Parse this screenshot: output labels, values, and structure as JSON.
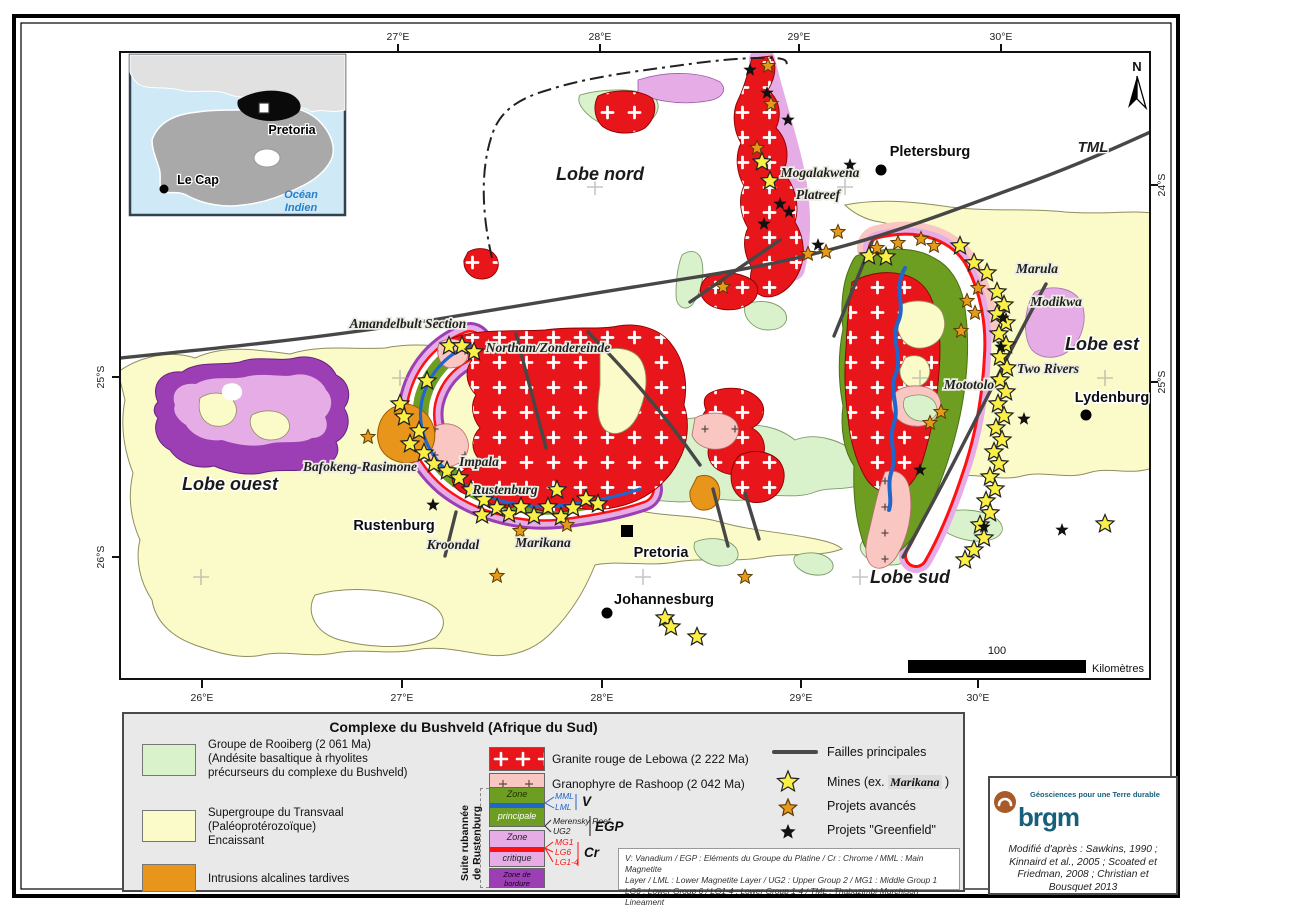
{
  "inset": {
    "pretoria": "Pretoria",
    "le_cap": "Le Cap",
    "ocean_line1": "Océan",
    "ocean_line2": "Indien"
  },
  "axes": {
    "top": [
      {
        "x": 398,
        "t": "27°E"
      },
      {
        "x": 600,
        "t": "28°E"
      },
      {
        "x": 799,
        "t": "29°E"
      },
      {
        "x": 1001,
        "t": "30°E"
      }
    ],
    "bottom": [
      {
        "x": 202,
        "t": "26°E"
      },
      {
        "x": 402,
        "t": "27°E"
      },
      {
        "x": 602,
        "t": "28°E"
      },
      {
        "x": 801,
        "t": "29°E"
      },
      {
        "x": 978,
        "t": "30°E"
      }
    ],
    "left": [
      {
        "y": 377,
        "t": "25°S"
      },
      {
        "y": 557,
        "t": "26°S"
      }
    ],
    "right": [
      {
        "y": 185,
        "t": "24°S"
      },
      {
        "y": 382,
        "t": "25°S"
      }
    ]
  },
  "map": {
    "north_label": "N",
    "fault_label": {
      "text": "TML",
      "x": 1093,
      "y": 152
    },
    "region_labels": [
      {
        "text": "Lobe nord",
        "x": 600,
        "y": 180
      },
      {
        "text": "Lobe ouest",
        "x": 230,
        "y": 490
      },
      {
        "text": "Lobe est",
        "x": 1102,
        "y": 350
      },
      {
        "text": "Lobe sud",
        "x": 910,
        "y": 583
      }
    ],
    "mine_labels": [
      {
        "text": "Amandelbult Section",
        "x": 408,
        "y": 328
      },
      {
        "text": "Northam/Zondereinde",
        "x": 548,
        "y": 352
      },
      {
        "text": "Bafokeng-Rasimone",
        "x": 360,
        "y": 471
      },
      {
        "text": "Impala",
        "x": 479,
        "y": 466
      },
      {
        "text": "Rustenburg",
        "x": 505,
        "y": 494
      },
      {
        "text": "Kroondal",
        "x": 453,
        "y": 549
      },
      {
        "text": "Marikana",
        "x": 543,
        "y": 547
      },
      {
        "text": "Mogalakwena",
        "x": 820,
        "y": 177
      },
      {
        "text": "Platreef",
        "x": 818,
        "y": 199
      },
      {
        "text": "Marula",
        "x": 1037,
        "y": 273
      },
      {
        "text": "Modikwa",
        "x": 1056,
        "y": 306
      },
      {
        "text": "Two Rivers",
        "x": 1048,
        "y": 373
      },
      {
        "text": "Mototolo",
        "x": 969,
        "y": 389
      }
    ],
    "cities": [
      {
        "name": "Pletersburg",
        "lx": 930,
        "ly": 156,
        "marker": "dot",
        "mx": 881,
        "my": 170
      },
      {
        "name": "Lydenburg",
        "lx": 1112,
        "ly": 402,
        "marker": "dot",
        "mx": 1086,
        "my": 415
      },
      {
        "name": "Pretoria",
        "lx": 661,
        "ly": 557,
        "marker": "square",
        "mx": 627,
        "my": 531
      },
      {
        "name": "Johannesburg",
        "lx": 664,
        "ly": 604,
        "marker": "dot",
        "mx": 607,
        "my": 613
      },
      {
        "name": "Rustenburg",
        "lx": 394,
        "ly": 530,
        "marker": "none",
        "mx": 0,
        "my": 0
      }
    ],
    "graticule": [
      [
        595,
        187
      ],
      [
        845,
        187
      ],
      [
        400,
        378
      ],
      [
        920,
        378
      ],
      [
        1105,
        378
      ],
      [
        201,
        577
      ],
      [
        643,
        577
      ],
      [
        860,
        577
      ]
    ],
    "scalebar": {
      "label": "100",
      "unit": "Kilomètres"
    },
    "stars": {
      "mines": [
        [
          449,
          346
        ],
        [
          462,
          346
        ],
        [
          474,
          352
        ],
        [
          427,
          381
        ],
        [
          400,
          404
        ],
        [
          404,
          417
        ],
        [
          419,
          431
        ],
        [
          410,
          444
        ],
        [
          424,
          453
        ],
        [
          434,
          464
        ],
        [
          447,
          471
        ],
        [
          459,
          478
        ],
        [
          471,
          490
        ],
        [
          484,
          500
        ],
        [
          497,
          508
        ],
        [
          482,
          515
        ],
        [
          509,
          514
        ],
        [
          521,
          507
        ],
        [
          534,
          516
        ],
        [
          548,
          507
        ],
        [
          561,
          517
        ],
        [
          573,
          508
        ],
        [
          586,
          499
        ],
        [
          557,
          490
        ],
        [
          598,
          504
        ],
        [
          869,
          256
        ],
        [
          886,
          257
        ],
        [
          960,
          246
        ],
        [
          974,
          263
        ],
        [
          987,
          273
        ],
        [
          997,
          292
        ],
        [
          1004,
          305
        ],
        [
          997,
          314
        ],
        [
          1006,
          323
        ],
        [
          999,
          334
        ],
        [
          1006,
          345
        ],
        [
          1000,
          357
        ],
        [
          1007,
          368
        ],
        [
          1000,
          380
        ],
        [
          1006,
          392
        ],
        [
          998,
          404
        ],
        [
          1004,
          416
        ],
        [
          996,
          428
        ],
        [
          1002,
          440
        ],
        [
          994,
          452
        ],
        [
          999,
          464
        ],
        [
          990,
          477
        ],
        [
          995,
          489
        ],
        [
          986,
          501
        ],
        [
          990,
          513
        ],
        [
          980,
          525
        ],
        [
          984,
          538
        ],
        [
          974,
          550
        ],
        [
          965,
          560
        ],
        [
          770,
          181
        ],
        [
          762,
          162
        ],
        [
          665,
          618
        ],
        [
          671,
          627
        ],
        [
          697,
          637
        ],
        [
          1105,
          524
        ]
      ],
      "advanced": [
        [
          768,
          66
        ],
        [
          771,
          104
        ],
        [
          757,
          148
        ],
        [
          838,
          232
        ],
        [
          826,
          252
        ],
        [
          808,
          254
        ],
        [
          723,
          287
        ],
        [
          877,
          248
        ],
        [
          898,
          243
        ],
        [
          921,
          239
        ],
        [
          934,
          246
        ],
        [
          978,
          288
        ],
        [
          967,
          301
        ],
        [
          975,
          313
        ],
        [
          961,
          331
        ],
        [
          941,
          412
        ],
        [
          930,
          423
        ],
        [
          368,
          437
        ],
        [
          520,
          531
        ],
        [
          567,
          525
        ],
        [
          497,
          576
        ],
        [
          745,
          577
        ]
      ],
      "greenfield": [
        [
          750,
          70
        ],
        [
          767,
          93
        ],
        [
          788,
          120
        ],
        [
          850,
          165
        ],
        [
          780,
          204
        ],
        [
          789,
          212
        ],
        [
          764,
          224
        ],
        [
          818,
          245
        ],
        [
          1003,
          318
        ],
        [
          1001,
          347
        ],
        [
          1024,
          419
        ],
        [
          920,
          470
        ],
        [
          984,
          527
        ],
        [
          1062,
          530
        ],
        [
          433,
          505
        ]
      ]
    }
  },
  "legend": {
    "title": "Complexe du Bushveld (Afrique du Sud)",
    "left_items": [
      {
        "lines": [
          "Groupe de Rooiberg (2 061 Ma)",
          "(Andésite basaltique à rhyolites",
          " précurseurs du complexe du Bushveld)"
        ]
      },
      {
        "lines": [
          "Supergroupe du Transvaal",
          "(Paléoprotérozoïque)",
          "Encaissant"
        ]
      },
      {
        "lines": [
          "Intrusions alcalines tardives"
        ]
      }
    ],
    "lebowa_label": "Granite rouge de Lebowa (2 222 Ma)",
    "rashoop_label": "Granophyre de Rashoop (2 042 Ma)",
    "suite_label_1": "Suite rubannée",
    "suite_label_2": "de Rustenburg",
    "zone_principale_1": "Zone",
    "zone_principale_2": "principale",
    "zone_critique_1": "Zone",
    "zone_critique_2": "critique",
    "zone_bordure_1": "Zone de",
    "zone_bordure_2": "bordure",
    "mml": "MML",
    "lml": "LML",
    "v": "V",
    "merensky": "Merensky Reef",
    "ug2": "UG2",
    "egp": "EGP",
    "mg1": "MG1",
    "lg6": "LG6",
    "lg14": "LG1-4",
    "cr": "Cr",
    "abbr_lines": [
      "V: Vanadium  /  EGP : Eléments du Groupe du Platine   /   Cr : Chrome   /   MML : Main Magnetite",
      "Layer  / LML : Lower Magnetite Layer  /  UG2 : Upper Group 2   /   MG1 : Middle Group 1",
      "LG6 : Lower Group 6   /   LG1-4 : Lower Group 1-4  /   TML : Thabazimbi-Murchison Lineament"
    ],
    "faults_label": "Failles principales",
    "mines_label_pre": "Mines (ex. ",
    "mines_label_ex": "Marikana",
    "mines_label_post": " )",
    "advanced_label": "Projets avancés",
    "greenfield_label": "Projets \"Greenfield\""
  },
  "brgm": {
    "logo_text": "brgm",
    "tagline": "Géosciences pour une Terre durable",
    "credit_lines": [
      "Modifié d'après : Sawkins, 1990 ;",
      "Kinnaird et al., 2005 ; Scoated et",
      "Friedman, 2008 ;  Christian et",
      "Bousquet 2013"
    ]
  },
  "colors": {
    "lebowa_red": "#e8151a",
    "rashoop_pink": "#f9c6c2",
    "rooiberg_green": "#d9f2cc",
    "transvaal_yellow": "#fbfac9",
    "zone_principale": "#6d9e21",
    "zone_critique": "#e6ace6",
    "zone_bordure": "#9c3fb5",
    "intrusions_orange": "#e8951c",
    "magnetite_blue": "#2166cb",
    "chromite_red": "#ff1111",
    "fault_gray": "#474747",
    "mine_star": "#f9ef45",
    "advanced_star": "#e59a1c",
    "greenfield_star": "#111111",
    "brgm_teal": "#17607c",
    "brgm_brown": "#a85a28",
    "ocean_blue": "#cfe9f7"
  }
}
